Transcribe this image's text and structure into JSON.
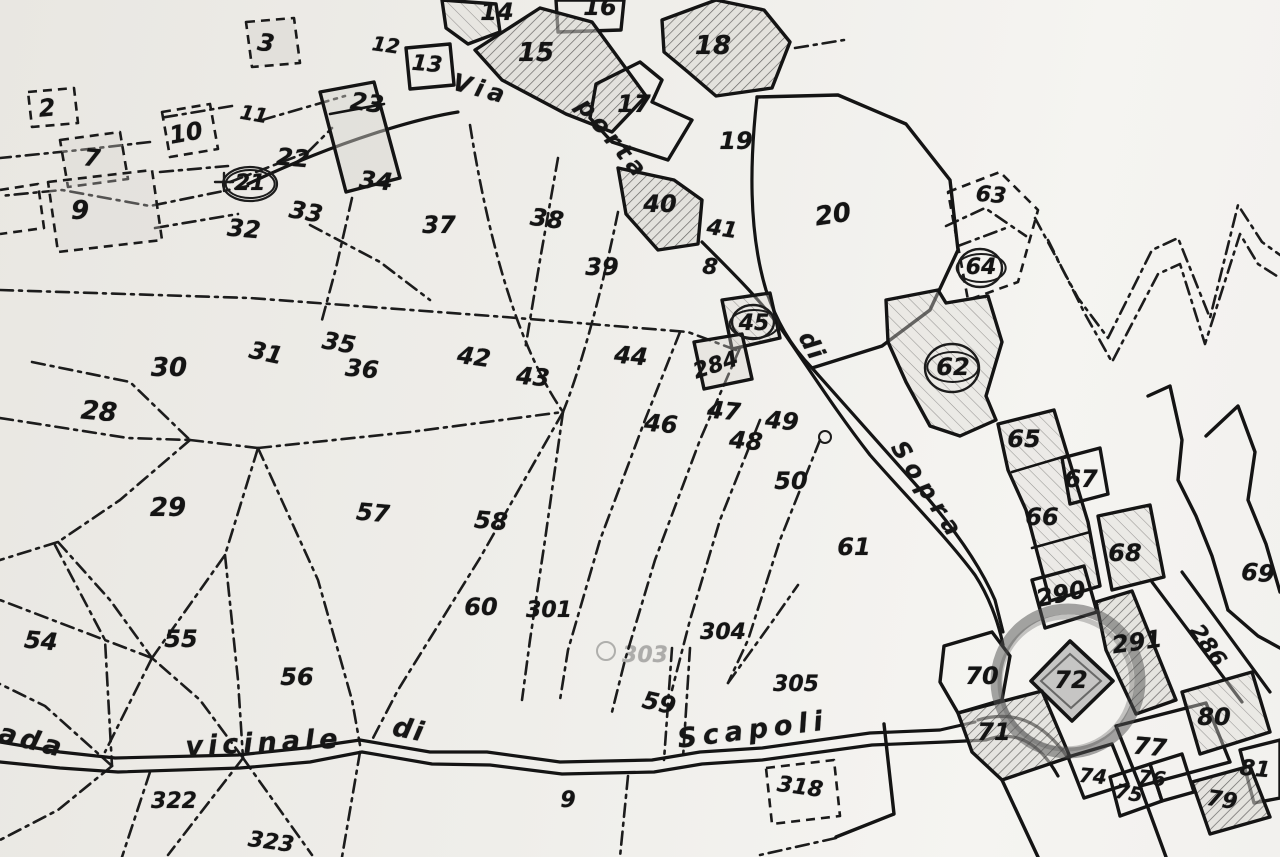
{
  "map": {
    "type": "scanned cadastral map",
    "road_names": [
      "Via porta di Sopra",
      "Strada vicinale di Scapoli"
    ],
    "colors": {
      "paper": "#edebe7",
      "ink": "#161616",
      "marker_ring": "#4f4f4f",
      "shade": "#b9b6b2"
    },
    "highlight": {
      "parcel": "72",
      "cx": 1068,
      "cy": 681,
      "r": 72,
      "width": 11,
      "opacity": 0.5
    },
    "streets": [
      {
        "t": "Via",
        "x": 481,
        "y": 89,
        "r": 15,
        "s": 24,
        "sp": 5
      },
      {
        "t": "porta",
        "x": 613,
        "y": 139,
        "r": 50,
        "s": 24,
        "sp": 5
      },
      {
        "t": "di",
        "x": 812,
        "y": 346,
        "r": 62,
        "s": 24,
        "sp": 2
      },
      {
        "t": "Sopra",
        "x": 928,
        "y": 491,
        "r": 57,
        "s": 24,
        "sp": 7
      },
      {
        "t": "ada",
        "x": 32,
        "y": 741,
        "r": 14,
        "s": 27,
        "sp": 4
      },
      {
        "t": "vicinale",
        "x": 264,
        "y": 743,
        "r": -3,
        "s": 27,
        "sp": 5
      },
      {
        "t": "di",
        "x": 409,
        "y": 730,
        "r": 12,
        "s": 27,
        "sp": 2
      },
      {
        "t": "Scapoli",
        "x": 753,
        "y": 730,
        "r": -7,
        "s": 27,
        "sp": 6
      }
    ],
    "parcels": [
      {
        "n": "2",
        "x": 47,
        "y": 108,
        "s": 24,
        "r": -5
      },
      {
        "n": "3",
        "x": 266,
        "y": 43,
        "s": 24,
        "r": 8
      },
      {
        "n": "7",
        "x": 92,
        "y": 158,
        "s": 24,
        "r": 5
      },
      {
        "n": "9",
        "x": 80,
        "y": 211,
        "s": 26,
        "r": 0
      },
      {
        "n": "10",
        "x": 186,
        "y": 133,
        "s": 24,
        "r": -10
      },
      {
        "n": "11",
        "x": 254,
        "y": 114,
        "s": 20,
        "r": 10
      },
      {
        "n": "12",
        "x": 386,
        "y": 45,
        "s": 20,
        "r": 8
      },
      {
        "n": "13",
        "x": 427,
        "y": 65,
        "s": 22,
        "r": 5
      },
      {
        "n": "14",
        "x": 497,
        "y": 12,
        "s": 24,
        "r": 0
      },
      {
        "n": "15",
        "x": 536,
        "y": 53,
        "s": 26,
        "r": 0
      },
      {
        "n": "16",
        "x": 600,
        "y": 7,
        "s": 24,
        "r": 0
      },
      {
        "n": "17",
        "x": 634,
        "y": 104,
        "s": 24,
        "r": 0
      },
      {
        "n": "18",
        "x": 713,
        "y": 46,
        "s": 26,
        "r": 0
      },
      {
        "n": "19",
        "x": 736,
        "y": 141,
        "s": 24,
        "r": 0
      },
      {
        "n": "20",
        "x": 833,
        "y": 215,
        "s": 26,
        "r": -8
      },
      {
        "n": "21",
        "x": 250,
        "y": 184,
        "s": 22,
        "r": 0,
        "circ": true
      },
      {
        "n": "22",
        "x": 293,
        "y": 158,
        "s": 24,
        "r": 5
      },
      {
        "n": "23",
        "x": 367,
        "y": 103,
        "s": 24,
        "r": 8
      },
      {
        "n": "28",
        "x": 99,
        "y": 412,
        "s": 26,
        "r": 5
      },
      {
        "n": "29",
        "x": 168,
        "y": 508,
        "s": 26,
        "r": 0
      },
      {
        "n": "30",
        "x": 169,
        "y": 368,
        "s": 26,
        "r": 0
      },
      {
        "n": "31",
        "x": 266,
        "y": 353,
        "s": 24,
        "r": 12
      },
      {
        "n": "32",
        "x": 244,
        "y": 229,
        "s": 24,
        "r": 5
      },
      {
        "n": "33",
        "x": 306,
        "y": 212,
        "s": 24,
        "r": 10
      },
      {
        "n": "34",
        "x": 376,
        "y": 181,
        "s": 24,
        "r": 5
      },
      {
        "n": "35",
        "x": 339,
        "y": 343,
        "s": 24,
        "r": 10
      },
      {
        "n": "36",
        "x": 362,
        "y": 369,
        "s": 24,
        "r": 5
      },
      {
        "n": "37",
        "x": 439,
        "y": 225,
        "s": 24,
        "r": 0
      },
      {
        "n": "38",
        "x": 547,
        "y": 219,
        "s": 24,
        "r": 8
      },
      {
        "n": "39",
        "x": 602,
        "y": 267,
        "s": 24,
        "r": 0
      },
      {
        "n": "40",
        "x": 660,
        "y": 204,
        "s": 24,
        "r": 0
      },
      {
        "n": "41",
        "x": 722,
        "y": 230,
        "s": 22,
        "r": 8
      },
      {
        "n": "8",
        "x": 710,
        "y": 268,
        "s": 22,
        "r": 5
      },
      {
        "n": "42",
        "x": 474,
        "y": 357,
        "s": 24,
        "r": 8
      },
      {
        "n": "43",
        "x": 533,
        "y": 377,
        "s": 24,
        "r": 5
      },
      {
        "n": "44",
        "x": 631,
        "y": 356,
        "s": 24,
        "r": 5
      },
      {
        "n": "45",
        "x": 754,
        "y": 324,
        "s": 22,
        "r": 0,
        "circ": true
      },
      {
        "n": "284",
        "x": 716,
        "y": 366,
        "s": 22,
        "r": -18
      },
      {
        "n": "46",
        "x": 661,
        "y": 424,
        "s": 24,
        "r": 5
      },
      {
        "n": "47",
        "x": 724,
        "y": 411,
        "s": 24,
        "r": 5
      },
      {
        "n": "48",
        "x": 746,
        "y": 441,
        "s": 24,
        "r": 5
      },
      {
        "n": "49",
        "x": 782,
        "y": 421,
        "s": 24,
        "r": 5
      },
      {
        "n": "50",
        "x": 791,
        "y": 481,
        "s": 24,
        "r": 0
      },
      {
        "n": "54",
        "x": 41,
        "y": 641,
        "s": 24,
        "r": 5
      },
      {
        "n": "55",
        "x": 181,
        "y": 639,
        "s": 24,
        "r": 0
      },
      {
        "n": "56",
        "x": 297,
        "y": 677,
        "s": 24,
        "r": 0
      },
      {
        "n": "57",
        "x": 373,
        "y": 513,
        "s": 24,
        "r": 5
      },
      {
        "n": "58",
        "x": 491,
        "y": 521,
        "s": 24,
        "r": 5
      },
      {
        "n": "59",
        "x": 659,
        "y": 703,
        "s": 24,
        "r": 12
      },
      {
        "n": "60",
        "x": 481,
        "y": 607,
        "s": 24,
        "r": 0
      },
      {
        "n": "301",
        "x": 549,
        "y": 611,
        "s": 22,
        "r": 0
      },
      {
        "n": "303",
        "x": 645,
        "y": 656,
        "s": 22,
        "r": 0,
        "faint": true
      },
      {
        "n": "304",
        "x": 723,
        "y": 633,
        "s": 22,
        "r": 0
      },
      {
        "n": "305",
        "x": 796,
        "y": 685,
        "s": 22,
        "r": 0
      },
      {
        "n": "61",
        "x": 854,
        "y": 547,
        "s": 24,
        "r": 0
      },
      {
        "n": "62",
        "x": 953,
        "y": 367,
        "s": 24,
        "r": 0,
        "circ": true
      },
      {
        "n": "63",
        "x": 991,
        "y": 196,
        "s": 22,
        "r": 5
      },
      {
        "n": "64",
        "x": 981,
        "y": 268,
        "s": 22,
        "r": 0,
        "circ": true
      },
      {
        "n": "65",
        "x": 1024,
        "y": 439,
        "s": 24,
        "r": 0
      },
      {
        "n": "66",
        "x": 1042,
        "y": 517,
        "s": 24,
        "r": 0
      },
      {
        "n": "67",
        "x": 1081,
        "y": 479,
        "s": 24,
        "r": 0
      },
      {
        "n": "68",
        "x": 1125,
        "y": 553,
        "s": 24,
        "r": 0
      },
      {
        "n": "69",
        "x": 1258,
        "y": 573,
        "s": 24,
        "r": 5
      },
      {
        "n": "70",
        "x": 982,
        "y": 676,
        "s": 24,
        "r": 0
      },
      {
        "n": "71",
        "x": 994,
        "y": 732,
        "s": 24,
        "r": 0
      },
      {
        "n": "72",
        "x": 1071,
        "y": 680,
        "s": 24,
        "r": 0
      },
      {
        "n": "74",
        "x": 1093,
        "y": 776,
        "s": 20,
        "r": 5
      },
      {
        "n": "75",
        "x": 1129,
        "y": 793,
        "s": 20,
        "r": 10
      },
      {
        "n": "76",
        "x": 1152,
        "y": 778,
        "s": 20,
        "r": 5
      },
      {
        "n": "77",
        "x": 1150,
        "y": 747,
        "s": 24,
        "r": 5
      },
      {
        "n": "79",
        "x": 1222,
        "y": 801,
        "s": 22,
        "r": 8
      },
      {
        "n": "80",
        "x": 1214,
        "y": 717,
        "s": 24,
        "r": 0
      },
      {
        "n": "81",
        "x": 1255,
        "y": 770,
        "s": 22,
        "r": 5
      },
      {
        "n": "286",
        "x": 1207,
        "y": 646,
        "s": 22,
        "r": 55
      },
      {
        "n": "290",
        "x": 1061,
        "y": 594,
        "s": 24,
        "r": -12
      },
      {
        "n": "291",
        "x": 1137,
        "y": 642,
        "s": 24,
        "r": -8
      },
      {
        "n": "318",
        "x": 800,
        "y": 788,
        "s": 22,
        "r": 8
      },
      {
        "n": "322",
        "x": 174,
        "y": 802,
        "s": 22,
        "r": 0
      },
      {
        "n": "323",
        "x": 271,
        "y": 843,
        "s": 22,
        "r": 8
      },
      {
        "n": "9",
        "x": 568,
        "y": 801,
        "s": 22,
        "r": 0
      }
    ]
  }
}
